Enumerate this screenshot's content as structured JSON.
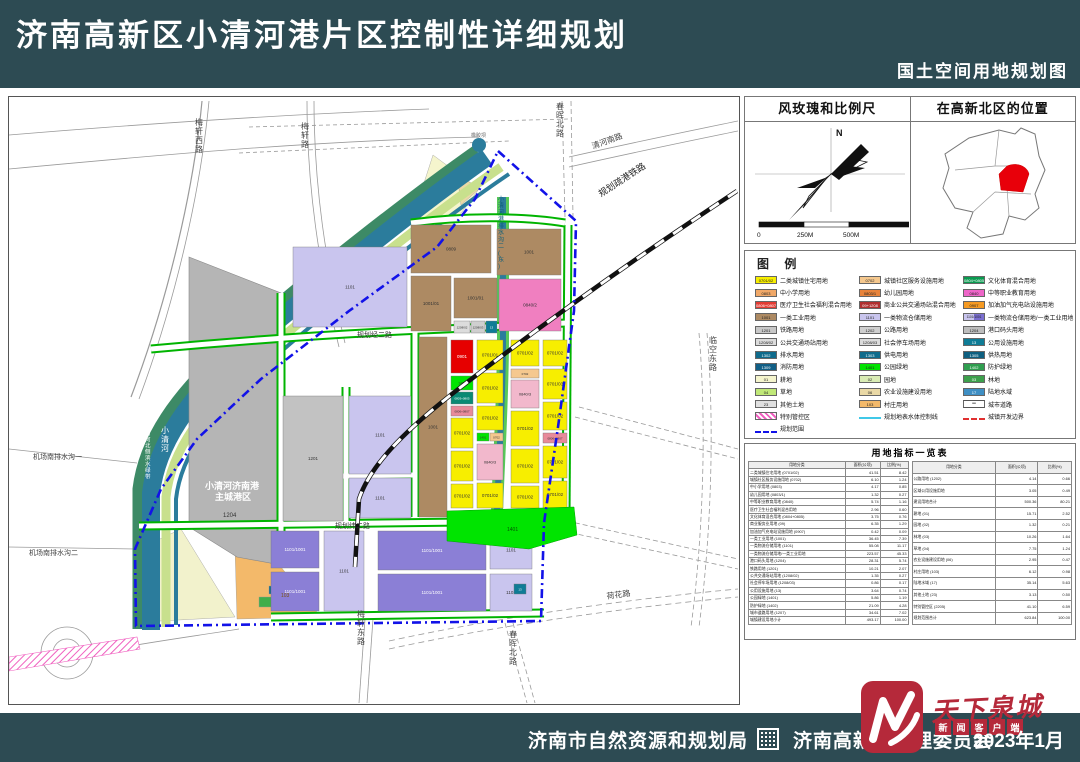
{
  "header": {
    "title": "济南高新区小清河港片区控制性详细规划",
    "subtitle": "国土空间用地规划图"
  },
  "footer": {
    "agency1": "济南市自然资源和规划局",
    "agency2": "济南高新区管理委员会",
    "date": "2023年1月"
  },
  "watermark": {
    "logo_text": "天下泉城",
    "sub_text": "新闻客户端"
  },
  "info": {
    "windrose_title": "风玫瑰和比例尺",
    "location_title": "在高新北区的位置",
    "north_label": "N",
    "scale_ticks": [
      "0",
      "250M",
      "500M",
      "1000M"
    ]
  },
  "legend": {
    "title": "图 例",
    "note": "注：特别管控区（持续推进开发区及济南港规划方案研究论证范围）涉及用地性质及规模指标待相关方案批复后，在国土空间规划“一张图”系统中动态更新，方可作为规划许可及开发管理依据。",
    "columns": [
      [
        {
          "code": "0701/02",
          "label": "二类城镇住宅用地",
          "fill": "#f7ee00"
        },
        {
          "code": "0803",
          "label": "中小学用地",
          "fill": "#f0a868"
        },
        {
          "code": "0806+0807",
          "label": "医疗卫生社会福利混合用地",
          "fill": "#e33b33",
          "tc": "#fff"
        },
        {
          "code": "1001",
          "label": "一类工业用地",
          "fill": "#ad8a63"
        },
        {
          "code": "1201",
          "label": "铁路用地",
          "fill": "#c8c8c8"
        },
        {
          "code": "1208/02",
          "label": "公共交通场站用地",
          "fill": "#dcdcdc"
        },
        {
          "code": "1302",
          "label": "排水用地",
          "fill": "#0f6b8c",
          "tc": "#fff"
        },
        {
          "code": "1309",
          "label": "消防用地",
          "fill": "#115f86",
          "tc": "#fff"
        },
        {
          "code": "01",
          "label": "耕地",
          "fill": "#f5f5cd"
        },
        {
          "code": "04",
          "label": "草地",
          "fill": "#c0e878"
        },
        {
          "code": "23",
          "label": "其他土地",
          "fill": "#e0e0e0"
        },
        {
          "code": "",
          "label": "特别管控区",
          "type": "hatch"
        },
        {
          "code": "",
          "label": "规划范围",
          "type": "dashblue"
        }
      ],
      [
        {
          "code": "0702",
          "label": "城镇社区服务设施用地",
          "fill": "#f5c88e"
        },
        {
          "code": "0803/1",
          "label": "幼儿园用地",
          "fill": "#e8833a"
        },
        {
          "code": "09+1208",
          "label": "商业公共交通场站混合用地",
          "fill": "#b03030",
          "tc": "#fff"
        },
        {
          "code": "1101",
          "label": "一类物流仓储用地",
          "fill": "#c9c5ee"
        },
        {
          "code": "1202",
          "label": "公路用地",
          "fill": "#cfcfcf"
        },
        {
          "code": "1208/03",
          "label": "社会停车场用地",
          "fill": "#dcdcdc"
        },
        {
          "code": "1303",
          "label": "供电用地",
          "fill": "#0f6b8c",
          "tc": "#fff"
        },
        {
          "code": "1401",
          "label": "公园绿地",
          "fill": "#00e400"
        },
        {
          "code": "02",
          "label": "园地",
          "fill": "#d9ecb4"
        },
        {
          "code": "06",
          "label": "农业设施建设用地",
          "fill": "#ead9a6"
        },
        {
          "code": "103",
          "label": "村庄用地",
          "fill": "#f3b96a"
        },
        {
          "code": "",
          "label": "规划地表水体控制线",
          "type": "water"
        }
      ],
      [
        {
          "code": "0804+0805",
          "label": "文化体育混合用地",
          "fill": "#0a9a50",
          "tc": "#fff"
        },
        {
          "code": "0840",
          "label": "中等职业教育用地",
          "fill": "#ee66c8"
        },
        {
          "code": "0907",
          "label": "加油加气充电站设施用地",
          "fill": "#f59a23"
        },
        {
          "code": "1101/1001",
          "label": "一类物流仓储用地/一类工业用地",
          "type": "split",
          "fill": "#c9c5ee",
          "fill2": "#7b6fd0"
        },
        {
          "code": "1204",
          "label": "港口码头用地",
          "fill": "#bdbdbd"
        },
        {
          "code": "13",
          "label": "公用设施用地",
          "fill": "#0f7c96",
          "tc": "#fff"
        },
        {
          "code": "1305",
          "label": "供热用地",
          "fill": "#0e5f80",
          "tc": "#fff"
        },
        {
          "code": "1402",
          "label": "防护绿地",
          "fill": "#2f9e4f",
          "tc": "#fff"
        },
        {
          "code": "03",
          "label": "林地",
          "fill": "#3da04c",
          "tc": "#fff"
        },
        {
          "code": "17",
          "label": "陆地水域",
          "fill": "#3f8fc4",
          "tc": "#fff"
        },
        {
          "code": "",
          "label": "城市道路",
          "type": "road"
        },
        {
          "code": "",
          "label": "城镇开发边界",
          "type": "dashred"
        }
      ]
    ]
  },
  "table": {
    "title": "用地指标一览表",
    "headers": [
      "用地分类",
      "面积(公顷)",
      "比例(%)"
    ],
    "left_rows": [
      [
        "二类城镇住宅用地 (0701/02)",
        "41.51",
        "8.42"
      ],
      [
        "城镇社区服务设施用地 (0702)",
        "6.10",
        "1.24"
      ],
      [
        "中小学用地 (0803)",
        "4.17",
        "0.85"
      ],
      [
        "幼儿园用地 (0803/1)",
        "1.32",
        "0.27"
      ],
      [
        "中等职业教育用地 (0840)",
        "5.74",
        "1.16"
      ],
      [
        "医疗卫生社会福利混合用地",
        "2.96",
        "0.60"
      ],
      [
        "文化体育混合用地 (0804+0805)",
        "3.75",
        "0.76"
      ],
      [
        "商业服务业用地 (09)",
        "6.35",
        "1.29"
      ],
      [
        "加油加气充电站设施用地 (0907)",
        "0.42",
        "0.09"
      ],
      [
        "一类工业用地 (1001)",
        "36.45",
        "7.39"
      ],
      [
        "一类物流仓储用地 (1101)",
        "55.08",
        "11.17"
      ],
      [
        "一类物流仓储用地/一类工业用地",
        "223.57",
        "45.33"
      ],
      [
        "港口码头用地 (1204)",
        "28.31",
        "5.74"
      ],
      [
        "铁路用地 (1201)",
        "10.21",
        "2.07"
      ],
      [
        "公共交通场站用地 (1208/02)",
        "1.35",
        "0.27"
      ],
      [
        "社会停车场用地 (1208/03)",
        "0.86",
        "0.17"
      ],
      [
        "公用设施用地 (13)",
        "3.64",
        "0.74"
      ],
      [
        "公园绿地 (1401)",
        "5.86",
        "1.19"
      ],
      [
        "防护绿地 (1402)",
        "21.09",
        "4.28"
      ],
      [
        "城市道路用地 (1207)",
        "34.61",
        "7.02"
      ],
      [
        "城镇建设用地小计",
        "493.17",
        "100.00"
      ]
    ],
    "right_rows": [
      [
        "公路用地 (1202)",
        "4.14",
        "0.66"
      ],
      [
        "区域公用设施用地",
        "3.05",
        "0.49"
      ],
      [
        "建设用地合计",
        "500.36",
        "80.21"
      ],
      [
        "耕地 (01)",
        "15.71",
        "2.52"
      ],
      [
        "园地 (02)",
        "1.32",
        "0.21"
      ],
      [
        "林地 (03)",
        "10.26",
        "1.64"
      ],
      [
        "草地 (04)",
        "7.75",
        "1.24"
      ],
      [
        "农业设施建设用地 (06)",
        "2.95",
        "0.47"
      ],
      [
        "村庄用地 (103)",
        "6.12",
        "0.98"
      ],
      [
        "陆地水域 (17)",
        "35.14",
        "5.63"
      ],
      [
        "其他土地 (23)",
        "3.13",
        "0.50"
      ],
      [
        "特别管控区 (2205)",
        "41.10",
        "6.59"
      ],
      [
        "规划范围合计",
        "623.84",
        "100.00"
      ]
    ]
  },
  "map": {
    "port_label_1": "小清河济南港",
    "port_label_2": "主城港区",
    "port_code": "1204",
    "blocks": [
      {
        "l": "0809",
        "x": 402,
        "y": 128,
        "w": 80,
        "h": 48,
        "f": "#ad8a63",
        "tc": "#333"
      },
      {
        "l": "1001",
        "x": 488,
        "y": 132,
        "w": 64,
        "h": 46,
        "f": "#ad8a63",
        "tc": "#333"
      },
      {
        "l": "0840/2",
        "x": 490,
        "y": 182,
        "w": 62,
        "h": 52,
        "f": "#f07fc0",
        "tc": "#333"
      },
      {
        "l": "1001/01",
        "x": 402,
        "y": 179,
        "w": 40,
        "h": 55,
        "f": "#ad8a63",
        "tc": "#333"
      },
      {
        "l": "1001/01",
        "x": 445,
        "y": 181,
        "w": 43,
        "h": 40,
        "f": "#ad8a63",
        "tc": "#333"
      },
      {
        "l": "1208/02",
        "x": 445,
        "y": 224,
        "w": 16,
        "h": 12,
        "f": "#dcdcdc",
        "fs": 3
      },
      {
        "l": "1208/03",
        "x": 462,
        "y": 224,
        "w": 14,
        "h": 12,
        "f": "#cfcfcf",
        "fs": 3
      },
      {
        "l": "13",
        "x": 477,
        "y": 224,
        "w": 11,
        "h": 12,
        "f": "#0f7c96",
        "tc": "#fff",
        "fs": 3
      },
      {
        "l": "1101",
        "x": 284,
        "y": 150,
        "w": 114,
        "h": 80,
        "f": "#c9c5ee",
        "tc": "#333"
      },
      {
        "l": "1001",
        "x": 410,
        "y": 240,
        "w": 28,
        "h": 180,
        "f": "#ad8a63",
        "tc": "#333"
      },
      {
        "l": "1201",
        "x": 274,
        "y": 299,
        "w": 60,
        "h": 125,
        "f": "#c2c2c2",
        "tc": "#333"
      },
      {
        "l": "1101",
        "x": 340,
        "y": 299,
        "w": 62,
        "h": 78,
        "f": "#c9c5ee",
        "tc": "#333"
      },
      {
        "l": "1101",
        "x": 340,
        "y": 381,
        "w": 62,
        "h": 40,
        "f": "#c9c5ee",
        "tc": "#333"
      },
      {
        "l": "0901",
        "x": 442,
        "y": 243,
        "w": 22,
        "h": 33,
        "f": "#e60000",
        "tc": "#fff"
      },
      {
        "l": "1401",
        "x": 442,
        "y": 279,
        "w": 22,
        "h": 14,
        "f": "#00e400",
        "fs": 3.5
      },
      {
        "l": "0803+0805",
        "x": 442,
        "y": 295,
        "w": 22,
        "h": 12,
        "f": "#0a8a74",
        "tc": "#fff",
        "fs": 3
      },
      {
        "l": "0806+0807",
        "x": 442,
        "y": 309,
        "w": 22,
        "h": 10,
        "f": "#e88a9a",
        "fs": 3
      },
      {
        "l": "0701/02",
        "x": 442,
        "y": 321,
        "w": 22,
        "h": 30,
        "f": "#f7ee00"
      },
      {
        "l": "0701/02",
        "x": 442,
        "y": 354,
        "w": 22,
        "h": 30,
        "f": "#f7ee00"
      },
      {
        "l": "0701/02",
        "x": 442,
        "y": 387,
        "w": 22,
        "h": 24,
        "f": "#f7ee00"
      },
      {
        "l": "0701/01",
        "x": 468,
        "y": 243,
        "w": 26,
        "h": 30,
        "f": "#f7ee00"
      },
      {
        "l": "0701/02",
        "x": 468,
        "y": 276,
        "w": 26,
        "h": 30,
        "f": "#f7ee00"
      },
      {
        "l": "0701/02",
        "x": 468,
        "y": 309,
        "w": 26,
        "h": 24,
        "f": "#f7ee00"
      },
      {
        "l": "1401",
        "x": 468,
        "y": 336,
        "w": 12,
        "h": 8,
        "f": "#00e400",
        "fs": 3
      },
      {
        "l": "0702",
        "x": 481,
        "y": 336,
        "w": 13,
        "h": 8,
        "f": "#f5c88e",
        "fs": 3
      },
      {
        "l": "0840/3",
        "x": 468,
        "y": 347,
        "w": 26,
        "h": 36,
        "f": "#f2b8cc",
        "fs": 4
      },
      {
        "l": "0701/02",
        "x": 468,
        "y": 386,
        "w": 26,
        "h": 25,
        "f": "#f7ee00"
      },
      {
        "l": "0701/02",
        "x": 502,
        "y": 243,
        "w": 28,
        "h": 26,
        "f": "#f7ee00"
      },
      {
        "l": "0702",
        "x": 502,
        "y": 272,
        "w": 28,
        "h": 9,
        "f": "#f5c88e",
        "fs": 3
      },
      {
        "l": "0840/3",
        "x": 502,
        "y": 283,
        "w": 28,
        "h": 28,
        "f": "#f2b8cc",
        "fs": 4
      },
      {
        "l": "0701/02",
        "x": 502,
        "y": 314,
        "w": 28,
        "h": 35,
        "f": "#f7ee00"
      },
      {
        "l": "0701/02",
        "x": 502,
        "y": 352,
        "w": 28,
        "h": 34,
        "f": "#f7ee00"
      },
      {
        "l": "0701/02",
        "x": 502,
        "y": 389,
        "w": 28,
        "h": 22,
        "f": "#f7ee00"
      },
      {
        "l": "0701/02",
        "x": 534,
        "y": 243,
        "w": 24,
        "h": 26,
        "f": "#f7ee00"
      },
      {
        "l": "0701/03",
        "x": 534,
        "y": 272,
        "w": 24,
        "h": 30,
        "f": "#f7ee00"
      },
      {
        "l": "0701/02",
        "x": 534,
        "y": 305,
        "w": 24,
        "h": 28,
        "f": "#f7ee00"
      },
      {
        "l": "0806+0807",
        "x": 534,
        "y": 336,
        "w": 24,
        "h": 10,
        "f": "#e88a9a",
        "fs": 3
      },
      {
        "l": "0701/02",
        "x": 534,
        "y": 349,
        "w": 24,
        "h": 32,
        "f": "#f7ee00"
      },
      {
        "l": "0701/02",
        "x": 534,
        "y": 384,
        "w": 24,
        "h": 27,
        "f": "#f7ee00"
      },
      {
        "l": "1101/1001",
        "x": 262,
        "y": 434,
        "w": 48,
        "h": 37,
        "f": "#8b7fd6",
        "tc": "#fff"
      },
      {
        "l": "1101/1001",
        "x": 262,
        "y": 475,
        "w": 48,
        "h": 39,
        "f": "#8b7fd6",
        "tc": "#fff"
      },
      {
        "l": "1101",
        "x": 315,
        "y": 434,
        "w": 40,
        "h": 80,
        "f": "#c9c5ee",
        "tc": "#333"
      },
      {
        "l": "1101/1001",
        "x": 369,
        "y": 434,
        "w": 108,
        "h": 39,
        "f": "#8b7fd6",
        "tc": "#fff"
      },
      {
        "l": "1101/1001",
        "x": 369,
        "y": 477,
        "w": 108,
        "h": 37,
        "f": "#8b7fd6",
        "tc": "#fff"
      },
      {
        "l": "1101",
        "x": 481,
        "y": 434,
        "w": 42,
        "h": 38,
        "f": "#c9c5ee",
        "tc": "#333"
      },
      {
        "l": "1101",
        "x": 481,
        "y": 477,
        "w": 42,
        "h": 37,
        "f": "#c9c5ee",
        "tc": "#333"
      },
      {
        "l": "13",
        "x": 505,
        "y": 487,
        "w": 12,
        "h": 10,
        "f": "#0f7c96",
        "tc": "#fff",
        "fs": 3
      }
    ],
    "labels": [
      {
        "t": "梅轩西路",
        "x": 186,
        "y": 28,
        "fs": 8,
        "vert": 1,
        "c": "#444"
      },
      {
        "t": "梅轩路",
        "x": 292,
        "y": 32,
        "fs": 8,
        "vert": 1,
        "c": "#444"
      },
      {
        "t": "春晖北路",
        "x": 547,
        "y": 12,
        "fs": 8,
        "vert": 1,
        "c": "#444"
      },
      {
        "t": "清河南路",
        "x": 584,
        "y": 52,
        "fs": 8,
        "rot": -20,
        "c": "#444"
      },
      {
        "t": "规划疏港铁路",
        "x": 592,
        "y": 100,
        "fs": 9,
        "rot": -33,
        "c": "#222"
      },
      {
        "t": "临空东路",
        "x": 700,
        "y": 246,
        "fs": 8,
        "vert": 1,
        "c": "#444"
      },
      {
        "t": "小清河港排水沟二(东)",
        "x": 489,
        "y": 104,
        "fs": 6,
        "vert": 1,
        "c": "#10607c"
      },
      {
        "t": "规划经二路",
        "x": 348,
        "y": 240,
        "fs": 7,
        "c": "#333"
      },
      {
        "t": "规划纬二路",
        "x": 326,
        "y": 431,
        "fs": 7,
        "c": "#333"
      },
      {
        "t": "小清河",
        "x": 152,
        "y": 336,
        "fs": 8,
        "vert": 1,
        "c": "#ffffff"
      },
      {
        "t": "小清河北侧滨水绿带",
        "x": 136,
        "y": 332,
        "fs": 5.5,
        "vert": 1,
        "c": "#ffffff"
      },
      {
        "t": "机场南排水沟一",
        "x": 24,
        "y": 362,
        "fs": 7,
        "c": "#444"
      },
      {
        "t": "机场南排水沟二",
        "x": 20,
        "y": 458,
        "fs": 7,
        "c": "#444"
      },
      {
        "t": "梅轩东路",
        "x": 348,
        "y": 520,
        "fs": 8,
        "vert": 1,
        "c": "#444"
      },
      {
        "t": "春晖北路",
        "x": 500,
        "y": 540,
        "fs": 8,
        "vert": 1,
        "c": "#444"
      },
      {
        "t": "荷花路",
        "x": 598,
        "y": 502,
        "fs": 8,
        "rot": -8,
        "c": "#444"
      },
      {
        "t": "橡胶坝",
        "x": 462,
        "y": 40,
        "fs": 5,
        "c": "#666"
      },
      {
        "t": "1401",
        "x": 498,
        "y": 434,
        "fs": 5,
        "c": "#035703"
      },
      {
        "t": "103",
        "x": 272,
        "y": 500,
        "fs": 5,
        "c": "#7a5210"
      }
    ]
  }
}
